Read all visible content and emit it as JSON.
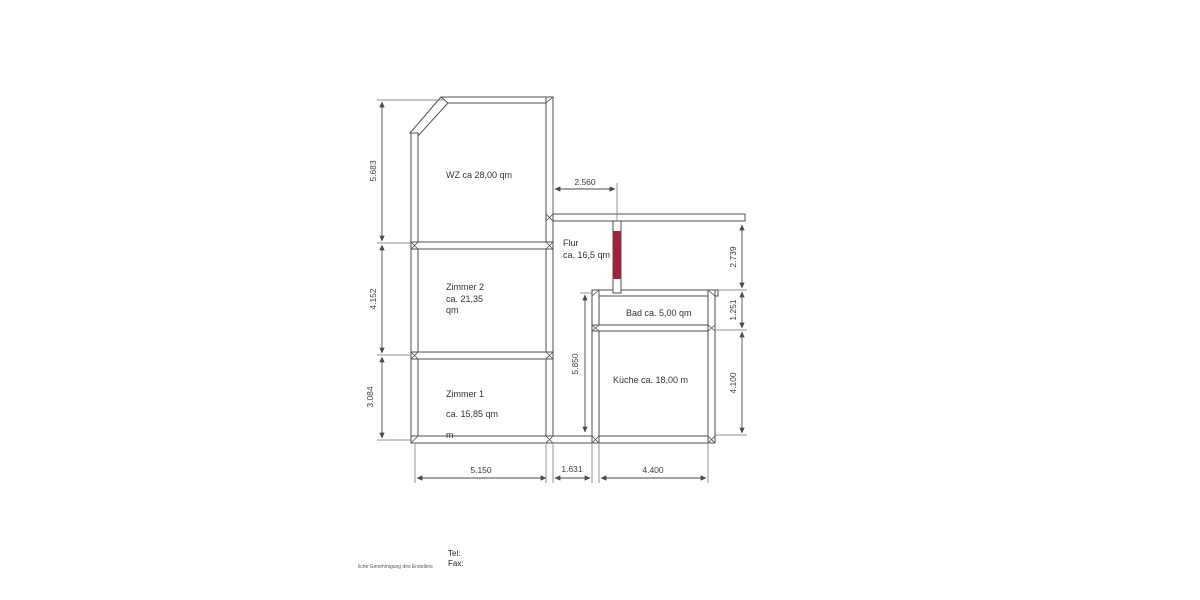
{
  "floorplan": {
    "rooms": {
      "wz": {
        "label": "WZ ca 28,00 qm"
      },
      "zimmer2": {
        "line1": "Zimmer 2",
        "line2": "ca. 21,35",
        "line3": "qm"
      },
      "zimmer1": {
        "line1": "Zimmer 1",
        "line2": "ca. 15,85 qm",
        "line3": "m"
      },
      "flur": {
        "line1": "Flur",
        "line2": "ca. 16,5 qm"
      },
      "bad": {
        "label": "Bad ca. 5,00 qm"
      },
      "kueche": {
        "label": "Küche ca. 18,00 m"
      }
    },
    "dimensions": {
      "left_top": "5.683",
      "left_middle": "4.152",
      "left_bottom": "3.084",
      "top": "2.560",
      "right_top": "2.739",
      "right_middle": "1.251",
      "right_bottom": "4.100",
      "flur_height": "5.850",
      "bottom_left": "5.150",
      "bottom_middle": "1.631",
      "bottom_right": "4.400"
    },
    "colors": {
      "line": "#4f4f4f",
      "door_marker": "#a81e3c",
      "text": "#333333"
    }
  },
  "footer": {
    "tel_label": "Tel:",
    "fax_label": "Fax:",
    "note": "liche Genehmigung des Erstellers"
  }
}
